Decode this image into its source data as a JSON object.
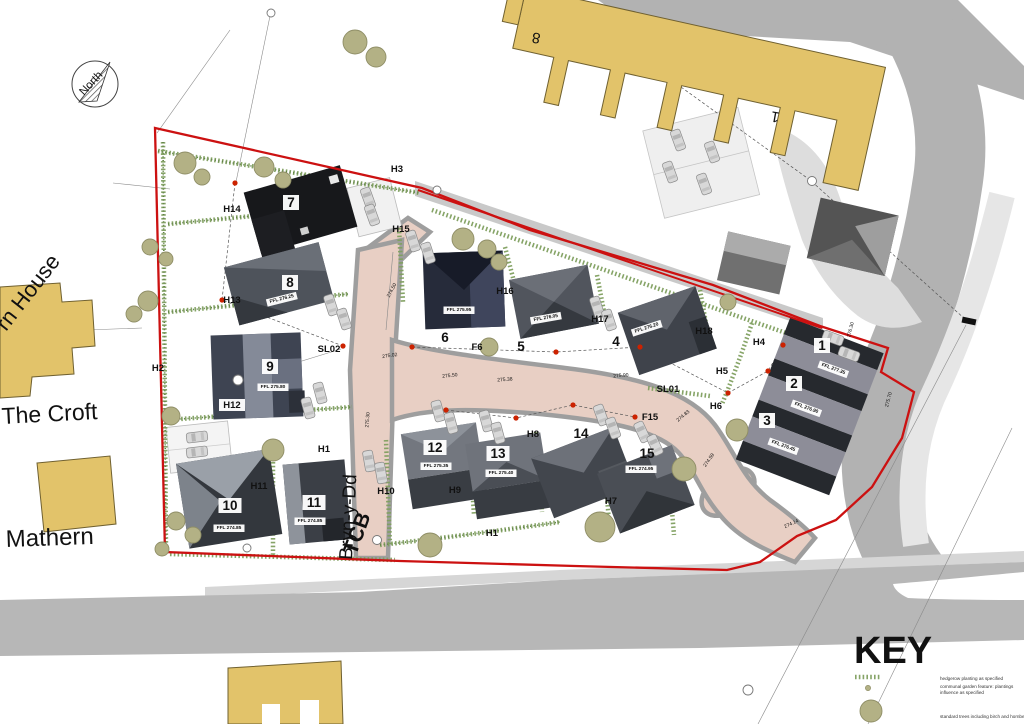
{
  "title": "Residential development site layout plan",
  "colors": {
    "boundary": "#cc1111",
    "shared_surface": "#e8cfc4",
    "existing_building": "#e2c36a",
    "hedgerow": "#7f9f5f",
    "tree": "#b3b185",
    "tree_stroke": "#8f8e66",
    "street_light_dot": "#cc2200",
    "road_gray": "#b5b5b5"
  },
  "north": {
    "label": "North"
  },
  "key": {
    "title": "KEY",
    "items": [
      {
        "swatch": "hedgerow-swatch",
        "label": "hedgerow planting as specified",
        "label2": ""
      },
      {
        "swatch": "garden-dot-swatch",
        "label": "communal garden feature: plantings",
        "label2": "influence as specified"
      },
      {
        "swatch": "tree-swatch",
        "label": "standard trees including birch and hornbeam",
        "label2": ""
      }
    ]
  },
  "context_labels": [
    {
      "t": "rn House",
      "x": 6,
      "y": 332,
      "r": -52,
      "s": 22,
      "a": "start",
      "w": 400
    },
    {
      "t": "The Croft",
      "x": 2,
      "y": 424,
      "r": -3,
      "s": 23,
      "a": "start",
      "w": 400
    },
    {
      "t": "Mathern",
      "x": 6,
      "y": 547,
      "r": -2,
      "s": 24,
      "a": "start",
      "w": 400
    },
    {
      "t": "Bryn-y-Dd",
      "x": 352,
      "y": 560,
      "r": -87,
      "s": 19,
      "a": "start",
      "w": 400
    },
    {
      "t": "TCB",
      "x": 356,
      "y": 556,
      "r": -70,
      "s": 21,
      "a": "start",
      "w": 600
    },
    {
      "t": "8",
      "x": 537,
      "y": 33,
      "r": 190,
      "s": 15,
      "a": "middle",
      "w": 400
    },
    {
      "t": "1",
      "x": 776,
      "y": 112,
      "r": 190,
      "s": 15,
      "a": "middle",
      "w": 400
    }
  ],
  "plot_labels": [
    {
      "n": "1",
      "x": 822,
      "y": 350,
      "boxed": true
    },
    {
      "n": "2",
      "x": 794,
      "y": 388,
      "boxed": true
    },
    {
      "n": "3",
      "x": 767,
      "y": 425,
      "boxed": true
    },
    {
      "n": "4",
      "x": 616,
      "y": 346,
      "boxed": false
    },
    {
      "n": "5",
      "x": 521,
      "y": 351,
      "boxed": false
    },
    {
      "n": "6",
      "x": 445,
      "y": 342,
      "boxed": false
    },
    {
      "n": "7",
      "x": 291,
      "y": 207,
      "boxed": true
    },
    {
      "n": "8",
      "x": 290,
      "y": 287,
      "boxed": true
    },
    {
      "n": "9",
      "x": 270,
      "y": 371,
      "boxed": true
    },
    {
      "n": "10",
      "x": 230,
      "y": 510,
      "boxed": true
    },
    {
      "n": "11",
      "x": 314,
      "y": 507,
      "boxed": true
    },
    {
      "n": "12",
      "x": 435,
      "y": 452,
      "boxed": true
    },
    {
      "n": "13",
      "x": 498,
      "y": 458,
      "boxed": true
    },
    {
      "n": "14",
      "x": 581,
      "y": 438,
      "boxed": false
    },
    {
      "n": "15",
      "x": 647,
      "y": 458,
      "boxed": false
    }
  ],
  "h_labels": [
    {
      "t": "H1",
      "x": 324,
      "y": 452,
      "boxed": false
    },
    {
      "t": "H1",
      "x": 492,
      "y": 536,
      "boxed": false
    },
    {
      "t": "H2",
      "x": 158,
      "y": 371,
      "boxed": false
    },
    {
      "t": "H3",
      "x": 397,
      "y": 172,
      "boxed": false
    },
    {
      "t": "H4",
      "x": 759,
      "y": 345,
      "boxed": false
    },
    {
      "t": "H5",
      "x": 722,
      "y": 374,
      "boxed": false
    },
    {
      "t": "H6",
      "x": 716,
      "y": 409,
      "boxed": false
    },
    {
      "t": "H7",
      "x": 611,
      "y": 504,
      "boxed": false
    },
    {
      "t": "H8",
      "x": 533,
      "y": 437,
      "boxed": false
    },
    {
      "t": "H9",
      "x": 455,
      "y": 493,
      "boxed": false
    },
    {
      "t": "H10",
      "x": 386,
      "y": 494,
      "boxed": false
    },
    {
      "t": "H11",
      "x": 259,
      "y": 489,
      "boxed": false
    },
    {
      "t": "H12",
      "x": 232,
      "y": 408,
      "boxed": true
    },
    {
      "t": "H13",
      "x": 232,
      "y": 303,
      "boxed": false
    },
    {
      "t": "H14",
      "x": 232,
      "y": 212,
      "boxed": false
    },
    {
      "t": "H15",
      "x": 401,
      "y": 232,
      "boxed": false
    },
    {
      "t": "H16",
      "x": 505,
      "y": 294,
      "boxed": false
    },
    {
      "t": "H17",
      "x": 600,
      "y": 322,
      "boxed": false
    },
    {
      "t": "H18",
      "x": 704,
      "y": 334,
      "boxed": false
    },
    {
      "t": "SL01",
      "x": 668,
      "y": 392,
      "boxed": false
    },
    {
      "t": "SL02",
      "x": 329,
      "y": 352,
      "boxed": false
    },
    {
      "t": "F15",
      "x": 650,
      "y": 420,
      "boxed": false
    },
    {
      "t": "F6",
      "x": 477,
      "y": 350,
      "boxed": false
    }
  ],
  "ffl_labels": [
    {
      "t": "FFL 277.35",
      "x": 833,
      "y": 370,
      "r": 20
    },
    {
      "t": "FFL 276.90",
      "x": 806,
      "y": 409,
      "r": 20
    },
    {
      "t": "FFL 276.45",
      "x": 783,
      "y": 447,
      "r": 20
    },
    {
      "t": "FFL 276.20",
      "x": 647,
      "y": 329,
      "r": -18
    },
    {
      "t": "FFL 276.05",
      "x": 546,
      "y": 319,
      "r": -10
    },
    {
      "t": "FFL 275.95",
      "x": 459,
      "y": 311,
      "r": 0
    },
    {
      "t": "FFL 276.25",
      "x": 282,
      "y": 300,
      "r": -14
    },
    {
      "t": "FFL 275.80",
      "x": 273,
      "y": 388,
      "r": 0
    },
    {
      "t": "FFL 274.85",
      "x": 229,
      "y": 529,
      "r": 0
    },
    {
      "t": "FFL 274.85",
      "x": 310,
      "y": 522,
      "r": 0
    },
    {
      "t": "FFL 275.35",
      "x": 436,
      "y": 467,
      "r": 0
    },
    {
      "t": "FFL 275.40",
      "x": 501,
      "y": 474,
      "r": 0
    },
    {
      "t": "FFL 274.95",
      "x": 641,
      "y": 470,
      "r": 0
    }
  ],
  "road_levels": [
    {
      "t": "274.50",
      "x": 393,
      "y": 291,
      "r": -62
    },
    {
      "t": "275.02",
      "x": 390,
      "y": 357,
      "r": -8
    },
    {
      "t": "275.50",
      "x": 450,
      "y": 377,
      "r": -6
    },
    {
      "t": "275.38",
      "x": 505,
      "y": 381,
      "r": -4
    },
    {
      "t": "275.30",
      "x": 369,
      "y": 420,
      "r": -85
    },
    {
      "t": "275.90",
      "x": 621,
      "y": 377,
      "r": -5
    },
    {
      "t": "274.83",
      "x": 684,
      "y": 417,
      "r": -40
    },
    {
      "t": "274.59",
      "x": 710,
      "y": 461,
      "r": -55
    },
    {
      "t": "274.14",
      "x": 792,
      "y": 525,
      "r": -25
    },
    {
      "t": "275.70",
      "x": 890,
      "y": 400,
      "r": -75
    },
    {
      "t": "276.30",
      "x": 852,
      "y": 330,
      "r": -75
    }
  ],
  "trees": [
    [
      185,
      163,
      11
    ],
    [
      202,
      177,
      8
    ],
    [
      264,
      167,
      10
    ],
    [
      283,
      180,
      8
    ],
    [
      355,
      42,
      12
    ],
    [
      376,
      57,
      10
    ],
    [
      150,
      247,
      8
    ],
    [
      166,
      259,
      7
    ],
    [
      148,
      301,
      10
    ],
    [
      134,
      314,
      8
    ],
    [
      171,
      416,
      9
    ],
    [
      176,
      521,
      9
    ],
    [
      193,
      535,
      8
    ],
    [
      162,
      549,
      7
    ],
    [
      273,
      450,
      11
    ],
    [
      463,
      239,
      11
    ],
    [
      487,
      249,
      9
    ],
    [
      499,
      262,
      8
    ],
    [
      489,
      347,
      9
    ],
    [
      430,
      545,
      12
    ],
    [
      600,
      527,
      15
    ],
    [
      684,
      469,
      12
    ],
    [
      737,
      430,
      11
    ],
    [
      728,
      302,
      8
    ]
  ],
  "cars": [
    [
      368,
      198,
      70
    ],
    [
      372,
      215,
      70
    ],
    [
      678,
      140,
      70
    ],
    [
      712,
      152,
      70
    ],
    [
      670,
      172,
      70
    ],
    [
      704,
      184,
      70
    ],
    [
      331,
      305,
      72
    ],
    [
      344,
      319,
      72
    ],
    [
      320,
      393,
      75
    ],
    [
      308,
      408,
      75
    ],
    [
      197,
      437,
      -7
    ],
    [
      197,
      452,
      -7
    ],
    [
      597,
      307,
      72
    ],
    [
      609,
      320,
      72
    ],
    [
      413,
      241,
      72
    ],
    [
      428,
      253,
      72
    ],
    [
      438,
      411,
      75
    ],
    [
      451,
      423,
      75
    ],
    [
      486,
      421,
      75
    ],
    [
      498,
      433,
      75
    ],
    [
      601,
      415,
      70
    ],
    [
      613,
      428,
      70
    ],
    [
      642,
      432,
      65
    ],
    [
      655,
      445,
      65
    ],
    [
      833,
      338,
      20
    ],
    [
      849,
      354,
      20
    ],
    [
      369,
      461,
      80
    ],
    [
      381,
      473,
      80
    ]
  ],
  "street_light_dots": [
    [
      235,
      183
    ],
    [
      222,
      300
    ],
    [
      343,
      346
    ],
    [
      412,
      347
    ],
    [
      556,
      352
    ],
    [
      640,
      347
    ],
    [
      446,
      410
    ],
    [
      516,
      418
    ],
    [
      573,
      405
    ],
    [
      635,
      417
    ],
    [
      728,
      393
    ],
    [
      783,
      345
    ],
    [
      768,
      371
    ]
  ],
  "survey_circles": [
    [
      238,
      380,
      5
    ],
    [
      812,
      181,
      4.5
    ],
    [
      437,
      190,
      4
    ],
    [
      247,
      548,
      4
    ],
    [
      377,
      540,
      4.5
    ],
    [
      748,
      690,
      5
    ],
    [
      271,
      13,
      4
    ]
  ]
}
